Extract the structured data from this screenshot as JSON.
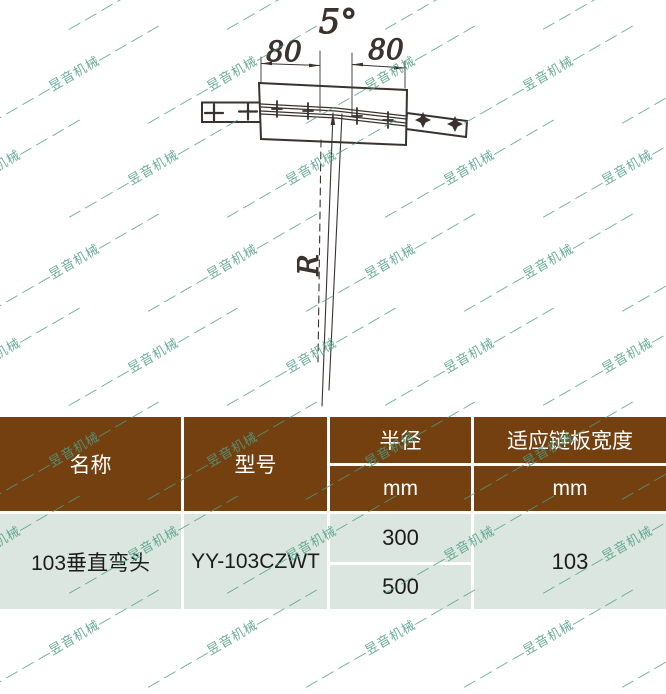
{
  "watermark": {
    "text": "— — — —昱音机械— — — —",
    "color": "#4f9e87"
  },
  "colors": {
    "header_bg": "#744010",
    "row_bg": "#dce6e0",
    "line": "#39322e"
  },
  "drawing": {
    "angle_label": "5°",
    "dim_left": "80",
    "dim_right": "80",
    "radius_label": "R"
  },
  "table": {
    "header": {
      "name": "名称",
      "model": "型号",
      "radius": "半径",
      "radius_unit": "mm",
      "plate_width": "适应链板宽度",
      "plate_width_unit": "mm"
    },
    "row": {
      "name": "103垂直弯头",
      "model": "YY-103CZWT",
      "radius_values": [
        "300",
        "500"
      ],
      "plate_width_value": "103"
    }
  }
}
